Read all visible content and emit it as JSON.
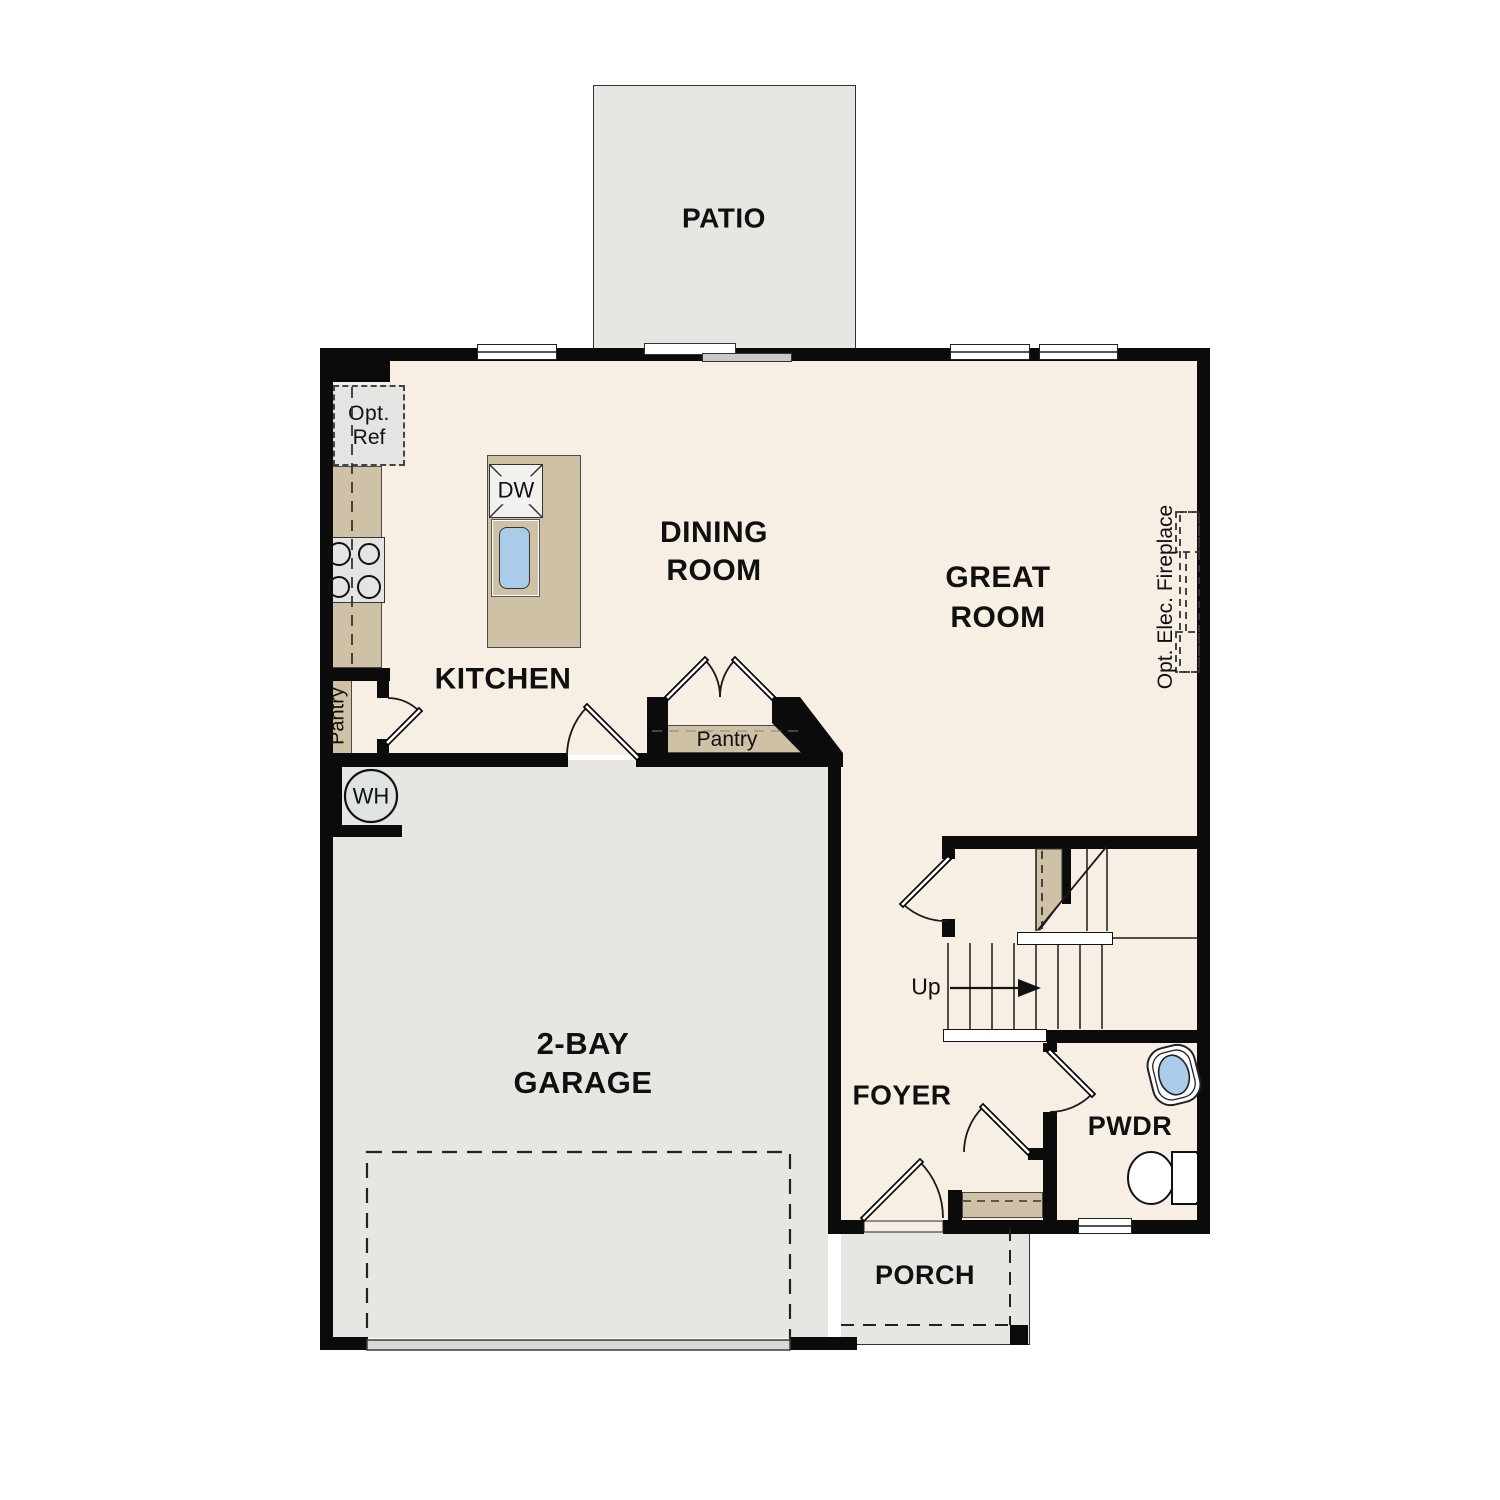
{
  "rooms": {
    "patio": {
      "label": "PATIO"
    },
    "dining": {
      "l1": "DINING",
      "l2": "ROOM"
    },
    "great": {
      "l1": "GREAT",
      "l2": "ROOM"
    },
    "kitchen": {
      "label": "KITCHEN"
    },
    "garage": {
      "l1": "2-BAY",
      "l2": "GARAGE"
    },
    "foyer": {
      "label": "FOYER"
    },
    "pwdr": {
      "label": "PWDR"
    },
    "porch": {
      "label": "PORCH"
    }
  },
  "annotations": {
    "opt_ref_l1": "Opt.",
    "opt_ref_l2": "Ref",
    "pantry_left": "Pantry",
    "pantry_center": "Pantry",
    "dishwasher": "DW",
    "water_heater": "WH",
    "stairs_up": "Up",
    "opt_elec_fireplace": "Opt. Elec. Fireplace"
  },
  "colors": {
    "floor_cream": "#f7efe4",
    "hardscape_gray": "#e7e6e3",
    "casework_tan": "#cfc1a6",
    "fixture_blue": "#aaccea",
    "wall_black": "#0b0b0b"
  }
}
